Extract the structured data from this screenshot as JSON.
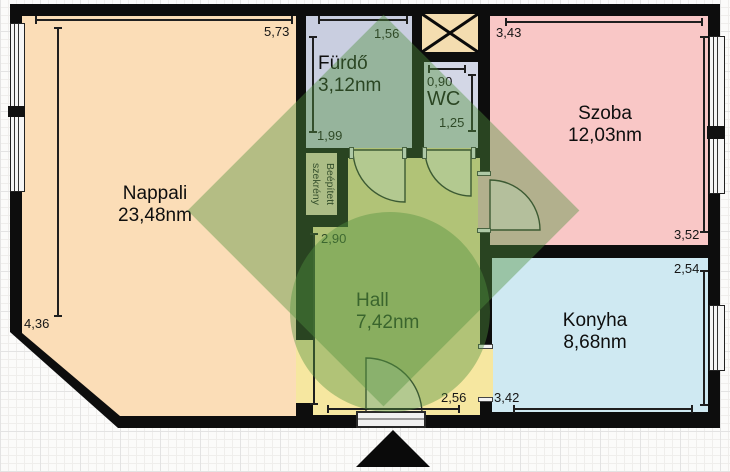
{
  "plan": {
    "rooms": {
      "nappali": {
        "name": "Nappali",
        "area": "23,48nm",
        "color": "#fbddb7"
      },
      "furdo": {
        "name": "Fürdő",
        "area": "3,12nm",
        "color": "#c9cee0"
      },
      "wc": {
        "name": "WC",
        "color": "#d3d7e6"
      },
      "szoba": {
        "name": "Szoba",
        "area": "12,03nm",
        "color": "#f9c7c6"
      },
      "konyha": {
        "name": "Konyha",
        "area": "8,68nm",
        "color": "#cfe9f2"
      },
      "hall": {
        "name": "Hall",
        "area": "7,42nm",
        "color": "#f6e7a0"
      },
      "szekreny": {
        "lines": [
          "Beépített",
          "szekrény"
        ],
        "color": "#eedcba"
      },
      "shaft": {
        "color": "#f4ddb0"
      }
    },
    "dimensions": {
      "nappali_top": "5,73",
      "nappali_left": "4,36",
      "furdo_top": "1,56",
      "furdo_left": "1,99",
      "wc_top": "0,90",
      "wc_right": "1,25",
      "szoba_top": "3,43",
      "szoba_right": "3,52",
      "konyha_right": "2,54",
      "konyha_bottom": "3,42",
      "hall_left": "2,90",
      "hall_bottom": "2,56"
    },
    "colors": {
      "wall": "#0d0d0d",
      "watermark": "rgba(80,145,62,0.42)",
      "door_swing": "rgba(255,255,255,0.45)"
    }
  }
}
